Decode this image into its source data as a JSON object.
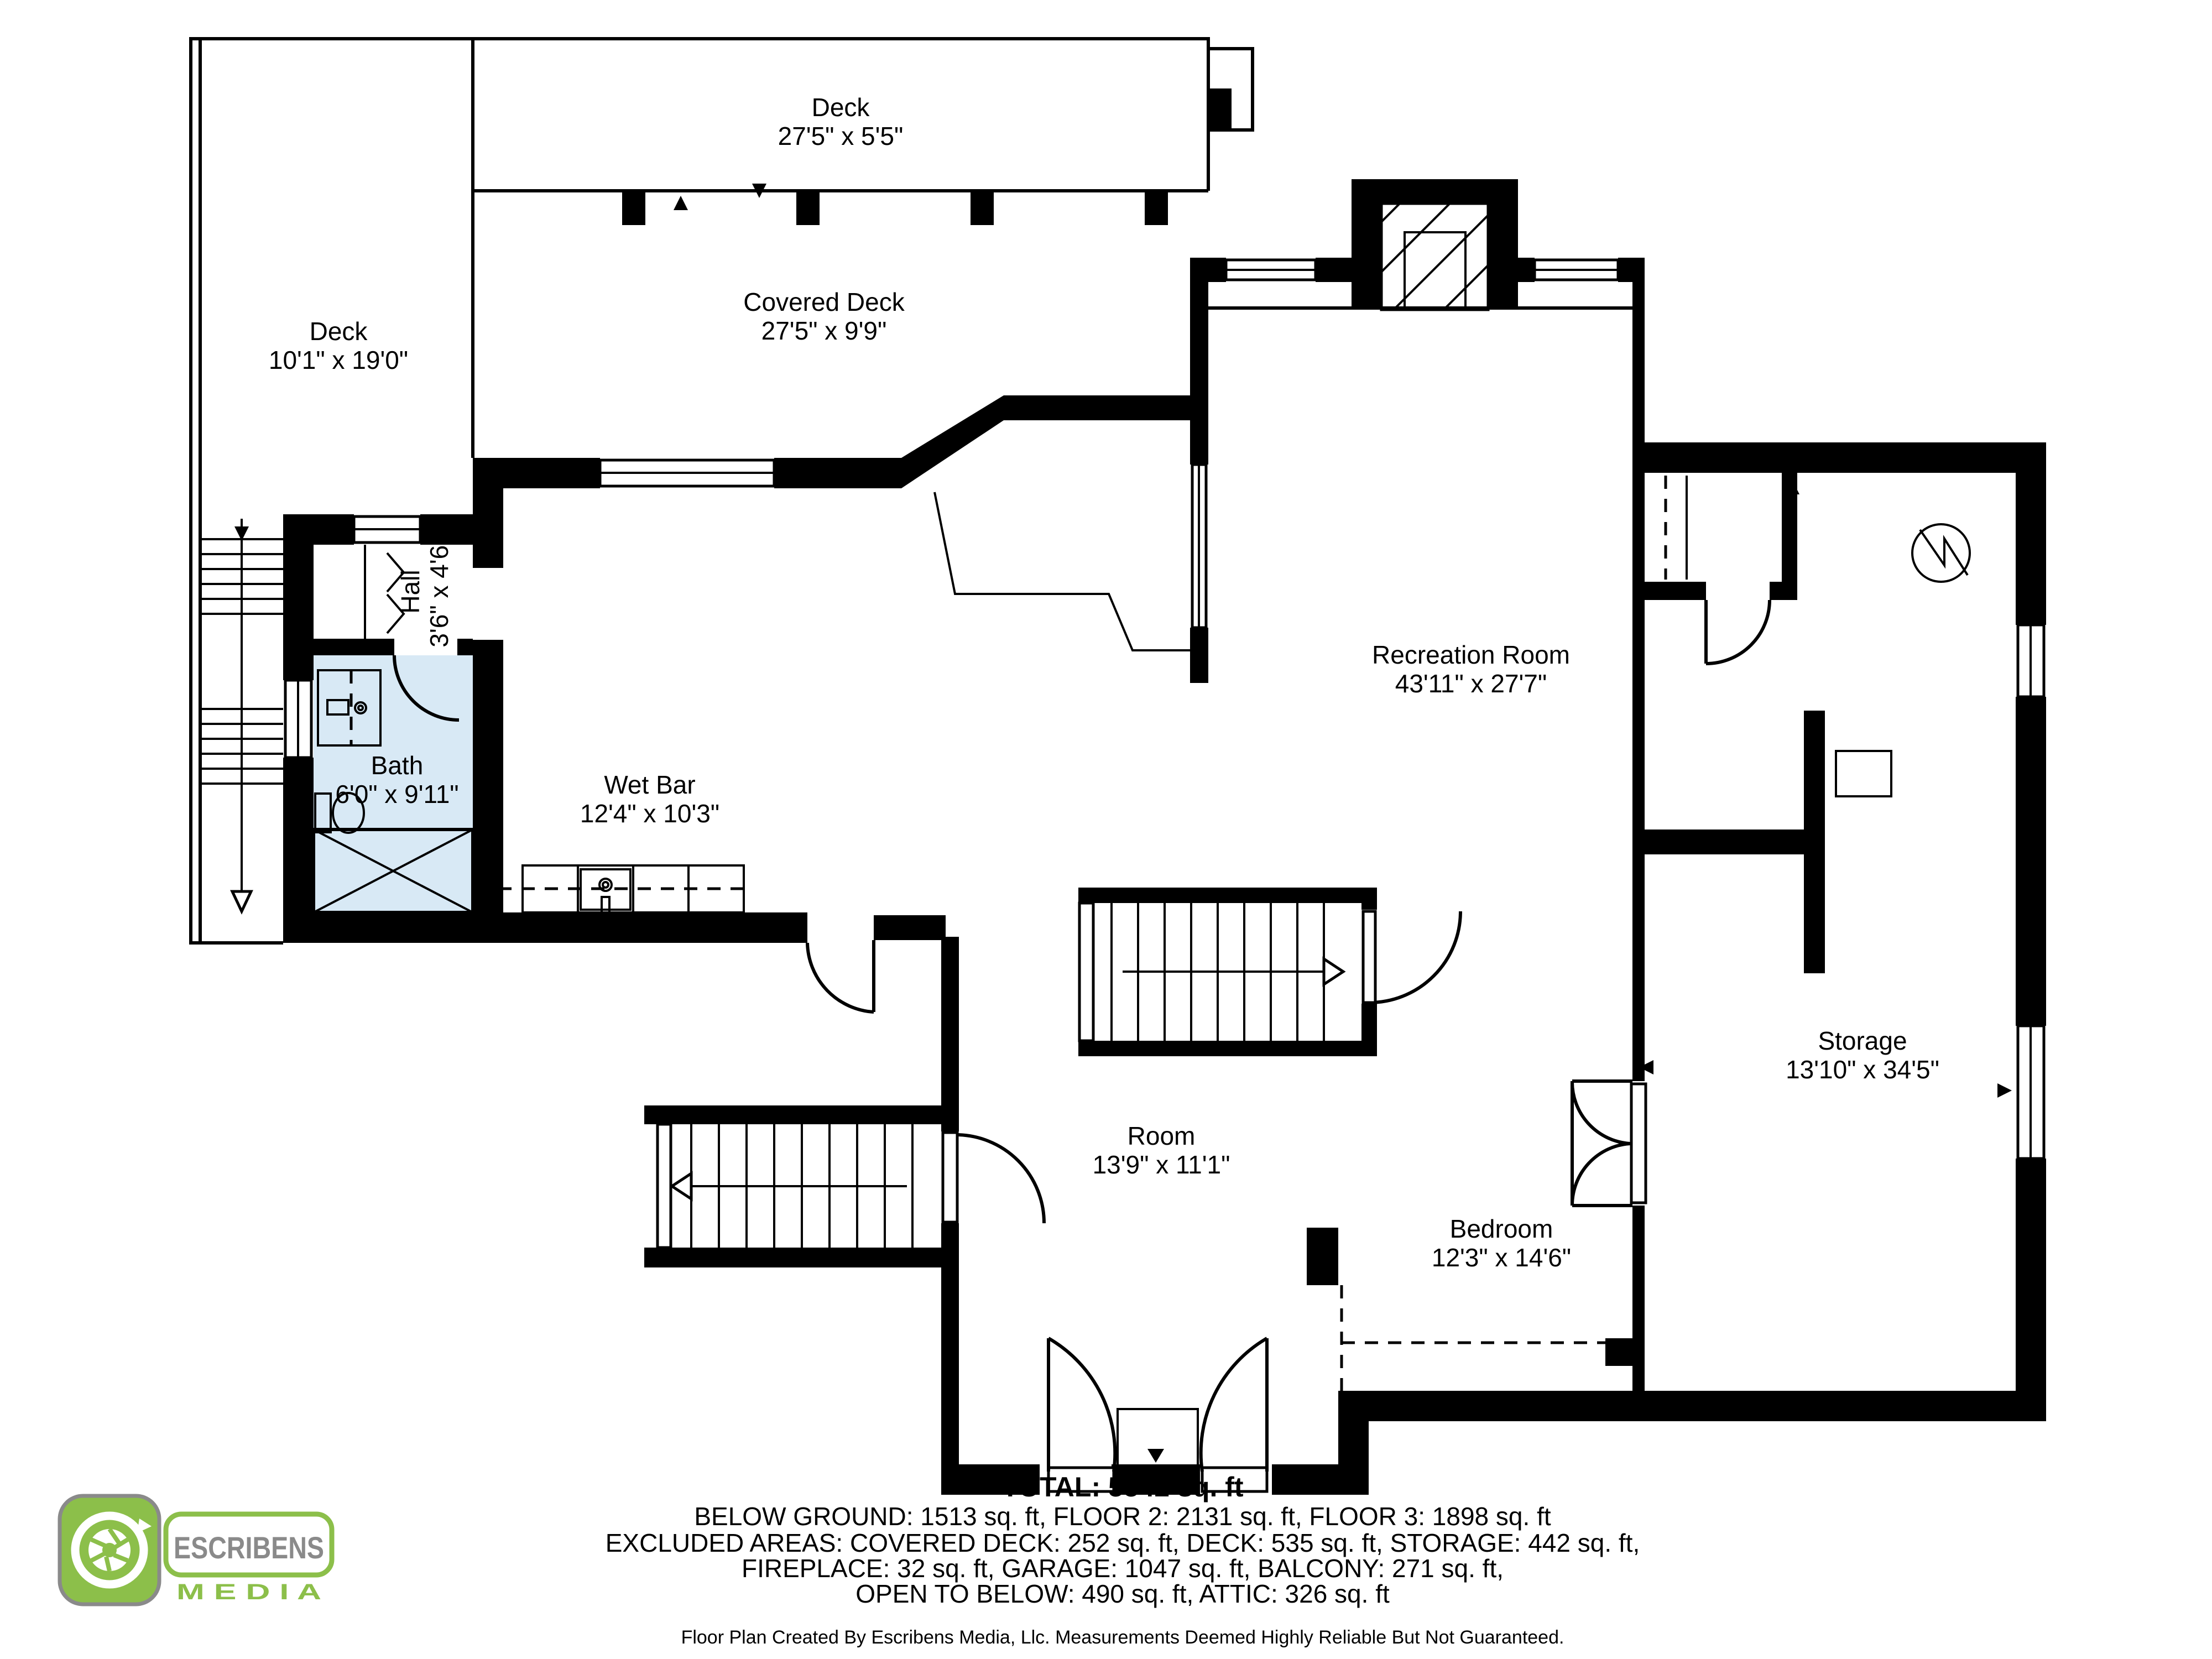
{
  "rooms": {
    "deck_top": {
      "name": "Deck",
      "dims": "27'5\" x 5'5\""
    },
    "deck_left": {
      "name": "Deck",
      "dims": "10'1\" x 19'0\""
    },
    "covered_deck": {
      "name": "Covered Deck",
      "dims": "27'5\" x 9'9\""
    },
    "recreation": {
      "name": "Recreation Room",
      "dims": "43'11\" x 27'7\""
    },
    "hall": {
      "name": "Hall",
      "dims": "3'6\" x 4'6\""
    },
    "bath": {
      "name": "Bath",
      "dims": "6'0\" x 9'11\""
    },
    "wet_bar": {
      "name": "Wet Bar",
      "dims": "12'4\" x 10'3\""
    },
    "room": {
      "name": "Room",
      "dims": "13'9\" x 11'1\""
    },
    "bedroom": {
      "name": "Bedroom",
      "dims": "12'3\" x 14'6\""
    },
    "storage": {
      "name": "Storage",
      "dims": "13'10\" x 34'5\""
    }
  },
  "footer": {
    "total": "TOTAL: 5542 sq. ft",
    "lines": [
      "BELOW GROUND: 1513 sq. ft, FLOOR 2: 2131 sq. ft, FLOOR 3: 1898 sq. ft",
      "EXCLUDED AREAS: COVERED DECK: 252 sq. ft, DECK: 535 sq. ft, STORAGE: 442 sq. ft,",
      "FIREPLACE: 32 sq. ft, GARAGE: 1047 sq. ft, BALCONY: 271 sq. ft,",
      "OPEN TO BELOW: 490 sq. ft, ATTIC: 326 sq. ft"
    ],
    "disclaimer": "Floor Plan Created By Escribens Media, Llc. Measurements Deemed Highly Reliable But Not Guaranteed."
  },
  "logo": {
    "brand": "ESCRIBENS",
    "sub": "M E D I A",
    "green": "#8cbf4a",
    "gray": "#8a8a8a"
  },
  "colors": {
    "bath_fill": "#d8e9f5",
    "wall": "#000000",
    "background": "#ffffff"
  }
}
